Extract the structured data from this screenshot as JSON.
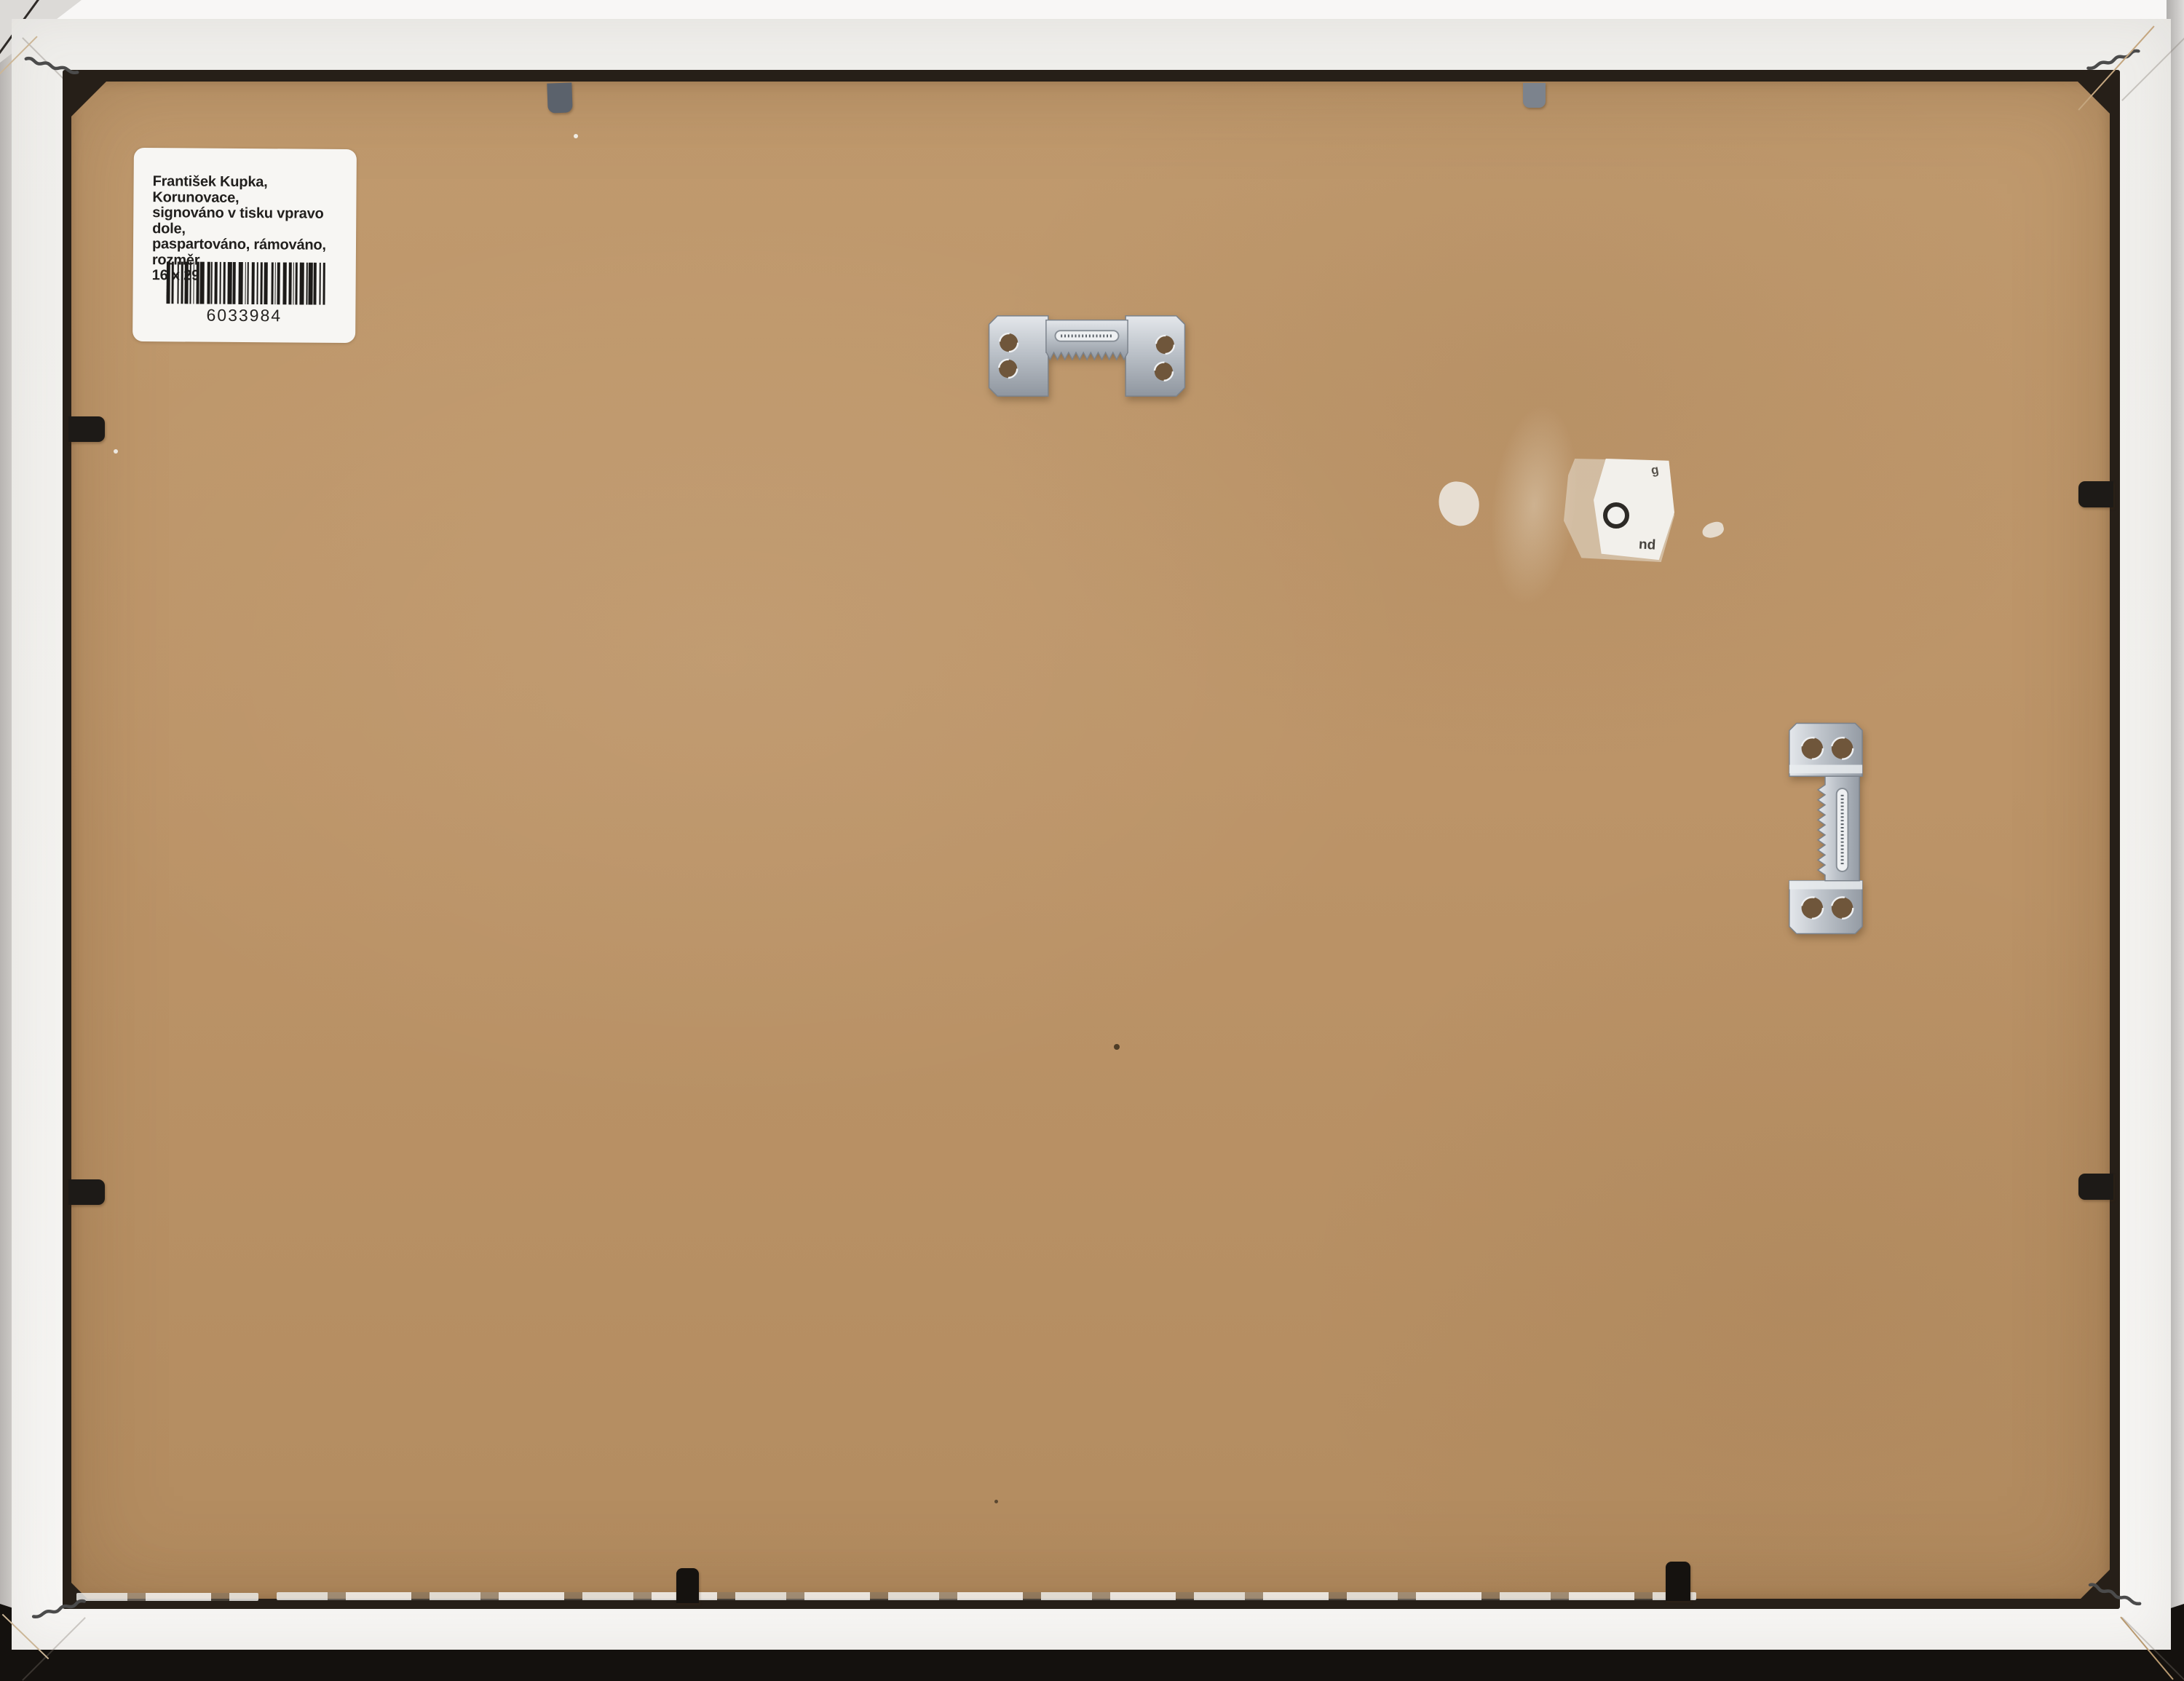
{
  "scene": {
    "description": "Back of a white picture frame with brown cardboard backing, inventory label, sawtooth hangers and retaining clips",
    "colors": {
      "background_top": "#f8f7f6",
      "background_bottom": "#14110e",
      "frame_white": "#f2f1ee",
      "cardboard": "#bc9468",
      "gap_shadow": "#261f18",
      "metal_light": "#dfe3e7",
      "metal_dark": "#8f969f",
      "clip_black": "#1d1a17",
      "clip_gray": "#5b626c",
      "label_white": "#f7f6f3"
    }
  },
  "label": {
    "lines": [
      "František Kupka, Korunovace,",
      "signováno v tisku vpravo dole,",
      "paspartováno, rámováno, rozměr",
      "16 x 29"
    ],
    "barcode_number": "6033984"
  },
  "residue_fragments": {
    "top": "g",
    "bottom": "pu"
  }
}
